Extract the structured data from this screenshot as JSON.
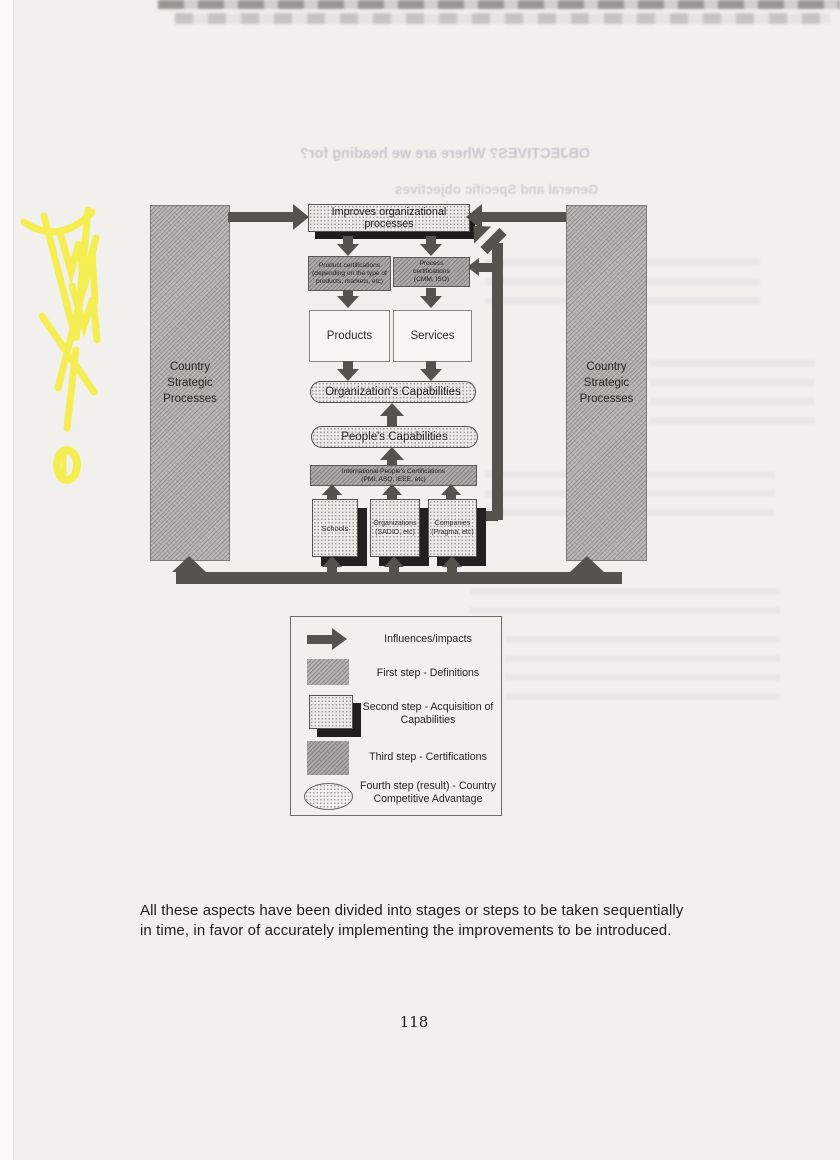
{
  "document": {
    "body_text": "All these aspects have been divided into stages or steps to be taken sequentially in time, in favor of accurately implementing the improvements to be introduced.",
    "page_number": "118"
  },
  "bleed_through": {
    "line1": "OBJECTIVES?   Where are we heading for?",
    "line2": "General and Specific objectives"
  },
  "diagram": {
    "left_column_label": "Country Strategic Processes",
    "right_column_label": "Country Strategic Processes",
    "top_box": "Improves organizational processes",
    "product_certifications": "Product certifications (depending on the type of products, markets, etc)",
    "process_certifications": "Process certifications (CMM, ISO)",
    "products": "Products",
    "services": "Services",
    "organization_capabilities": "Organization's Capabilities",
    "people_capabilities": "People's Capabilities",
    "international_certifications_line1": "International People's Certifications",
    "international_certifications_line2": "(PMI, ASQ, IEEE, etc)",
    "schools": "Schools",
    "organizations_line1": "Organizations",
    "organizations_line2": "(SADIO, etc)",
    "companies_line1": "Companies",
    "companies_line2": "(Pragma, etc)"
  },
  "legend": {
    "influences": "Influences/impacts",
    "first_step": "First step - Definitions",
    "second_step": "Second step - Acquisition of Capabilities",
    "third_step": "Third step - Certifications",
    "fourth_step": "Fourth step (result) - Country Competitive Advantage"
  },
  "colors": {
    "arrow": "#55534e",
    "column_fill": "#b6b4b0",
    "certification_fill": "#adaba7",
    "box_shadow": "#22211f",
    "highlighter": "#f6ee3e",
    "paper": "#f2f0ec"
  }
}
